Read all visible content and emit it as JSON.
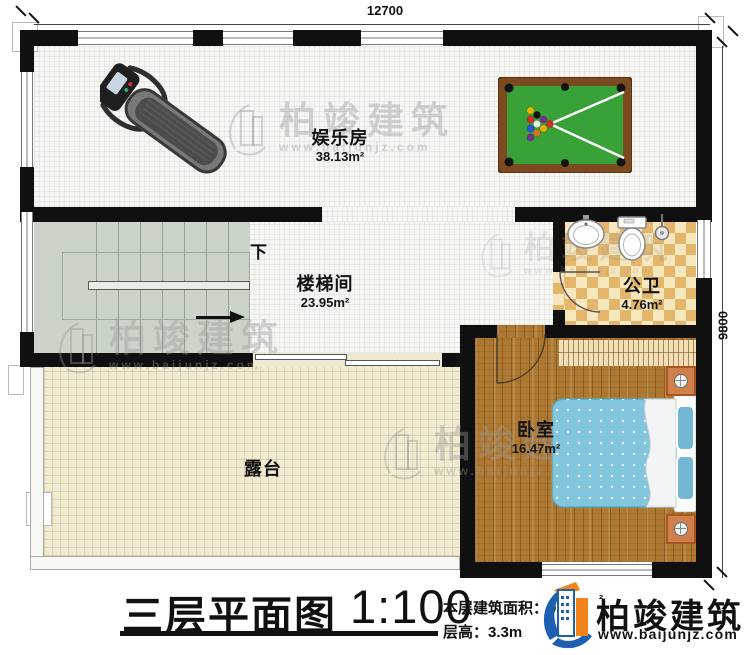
{
  "dimensions": {
    "top": "12700",
    "right": "9800"
  },
  "rooms": {
    "entertainment": {
      "name": "娱乐房",
      "area": "38.13m²"
    },
    "stairwell": {
      "name": "楼梯间",
      "area": "23.95m²",
      "direction_label": "下"
    },
    "bathroom": {
      "name": "公卫",
      "area": "4.76m²"
    },
    "bedroom": {
      "name": "卧室",
      "area": "16.47m²"
    },
    "terrace": {
      "name": "露台"
    }
  },
  "title_block": {
    "plan_title": "三层平面图",
    "scale": "1:100",
    "area_label": "本层建筑面积：",
    "area_value": "97",
    "area_sup": "²",
    "floor_height_label": "层高：",
    "floor_height_value": "3.3m"
  },
  "brand": {
    "name": "柏竣建筑",
    "url": "www.baijunjz.com"
  },
  "watermark": {
    "name": "柏竣建筑",
    "url": "www.baijunjz.com"
  },
  "colors": {
    "brand_blue": "#1f5fb2",
    "brand_orange": "#f08418",
    "wall": "#101010",
    "pool_felt": "#38a138",
    "bed_blue": "#82c5dc"
  }
}
